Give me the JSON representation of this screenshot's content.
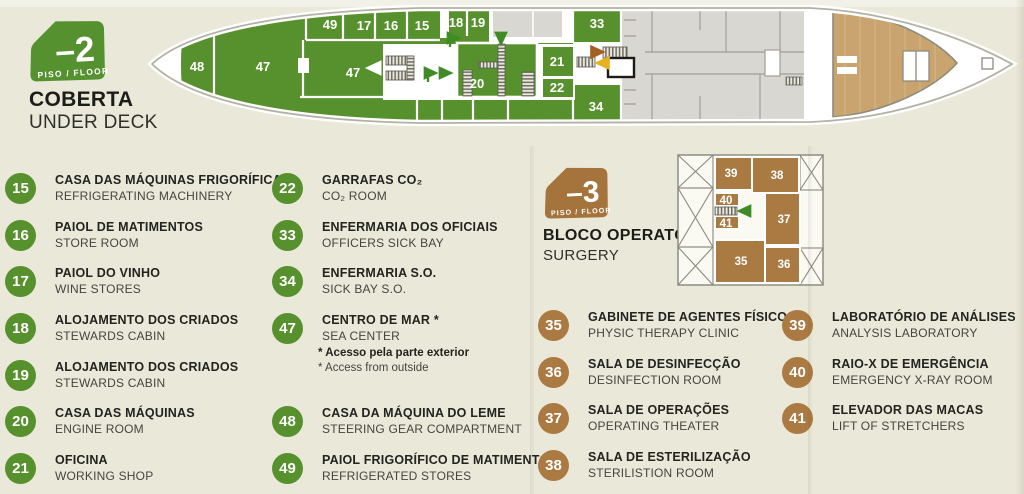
{
  "colors": {
    "deck_green": "#57912d",
    "deck_brown": "#aa7a42",
    "stern_wood_tan": "#c9a46f",
    "other_deck_gray": "#d8d7d1",
    "paper": "#eae8d9",
    "arrow_green": "#3f8c26",
    "arrow_brown": "#a35f22",
    "arrow_yellow": "#e7b020"
  },
  "deck_under": {
    "badge_level": "–2",
    "badge_floor": "PISO / FLOOR",
    "title_pt": "COBERTA",
    "title_en": "UNDER DECK",
    "plan_labels": [
      "48",
      "47",
      "49",
      "17",
      "16",
      "15",
      "18",
      "19",
      "47",
      "20",
      "21",
      "22",
      "33",
      "34"
    ],
    "legend": [
      {
        "num": "15",
        "pt": "CASA DAS MÁQUINAS FRIGORÍFICAS",
        "en": "REFRIGERATING MACHINERY"
      },
      {
        "num": "16",
        "pt": "PAIOL DE MATIMENTOS",
        "en": "STORE ROOM"
      },
      {
        "num": "17",
        "pt": "PAIOL DO VINHO",
        "en": "WINE STORES"
      },
      {
        "num": "18",
        "pt": "ALOJAMENTO DOS CRIADOS",
        "en": "STEWARDS CABIN"
      },
      {
        "num": "19",
        "pt": "ALOJAMENTO DOS CRIADOS",
        "en": "STEWARDS CABIN"
      },
      {
        "num": "20",
        "pt": "CASA DAS MÁQUINAS",
        "en": "ENGINE ROOM"
      },
      {
        "num": "21",
        "pt": "OFICINA",
        "en": "WORKING SHOP"
      },
      {
        "num": "22",
        "pt": "GARRAFAS CO₂",
        "en": "CO₂ ROOM"
      },
      {
        "num": "33",
        "pt": "ENFERMARIA DOS OFICIAIS",
        "en": "OFFICERS SICK BAY"
      },
      {
        "num": "34",
        "pt": "ENFERMARIA S.O.",
        "en": "SICK BAY S.O."
      },
      {
        "num": "47",
        "pt": "CENTRO DE MAR *",
        "en": "SEA CENTER"
      },
      {
        "num": "48",
        "pt": "CASA DA MÁQUINA DO LEME",
        "en": "STEERING GEAR COMPARTMENT"
      },
      {
        "num": "49",
        "pt": "PAIOL FRIGORÍFICO DE MATIMENTOS",
        "en": "REFRIGERATED STORES"
      }
    ],
    "footnote_pt": "* Acesso pela parte exterior",
    "footnote_en": "* Access from outside"
  },
  "deck_surgery": {
    "badge_level": "–3",
    "badge_floor": "PISO / FLOOR",
    "title_pt": "BLOCO OPERATÓRIO",
    "title_en": "SURGERY",
    "plan_labels": [
      "39",
      "38",
      "40",
      "41",
      "37",
      "35",
      "36"
    ],
    "legend": [
      {
        "num": "35",
        "pt": "GABINETE DE AGENTES FÍSICOS",
        "en": "PHYSIC THERAPY CLINIC"
      },
      {
        "num": "36",
        "pt": "SALA DE DESINFECÇÃO",
        "en": "DESINFECTION ROOM"
      },
      {
        "num": "37",
        "pt": "SALA DE OPERAÇÕES",
        "en": "OPERATING THEATER"
      },
      {
        "num": "38",
        "pt": "SALA DE ESTERILIZAÇÃO",
        "en": "STERILISTION ROOM"
      },
      {
        "num": "39",
        "pt": "LABORATÓRIO DE ANÁLISES",
        "en": "ANALYSIS LABORATORY"
      },
      {
        "num": "40",
        "pt": "RAIO-X DE EMERGÊNCIA",
        "en": "EMERGENCY X-RAY ROOM"
      },
      {
        "num": "41",
        "pt": "ELEVADOR DAS MACAS",
        "en": "LIFT OF STRETCHERS"
      }
    ]
  },
  "symbols": {
    "stairs": "hatched-treads",
    "lift": "black-outline-box",
    "direction_arrows": [
      "green",
      "brown",
      "yellow",
      "white"
    ]
  }
}
